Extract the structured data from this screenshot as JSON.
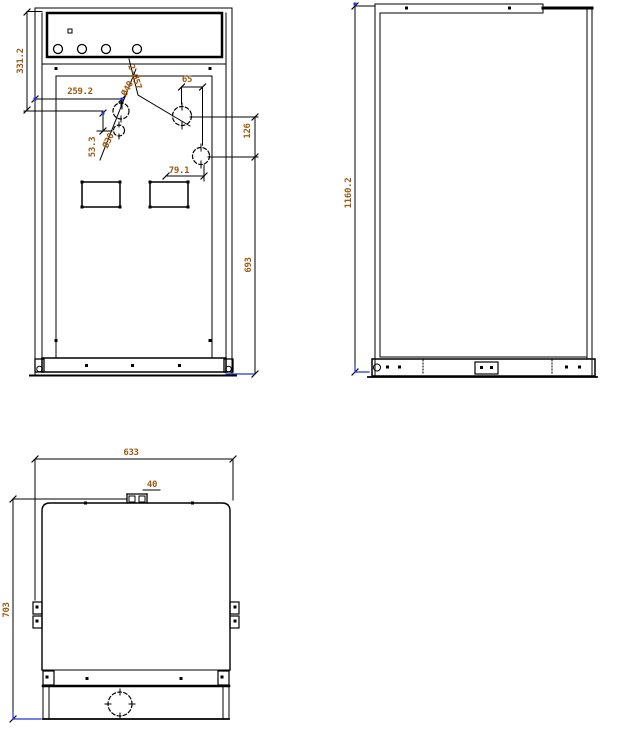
{
  "front_view": {
    "dim_upper_height": "331.2",
    "dim_upper_width": "259.2",
    "dim_hole_gap": "53.3",
    "hole_small": "Ø30",
    "hole_mid": "Ø40",
    "hole_pair": "2-Ø57",
    "dim_65": "65",
    "dim_126": "126",
    "dim_79_1": "79.1",
    "dim_693": "693"
  },
  "side_view": {
    "dim_height": "1160.2"
  },
  "plan_view": {
    "dim_width": "633",
    "dim_bump": "40",
    "dim_depth": "703"
  },
  "colors": {
    "line": "#000000",
    "dim_text": "#9c5a15",
    "grip": "#2233dd"
  }
}
